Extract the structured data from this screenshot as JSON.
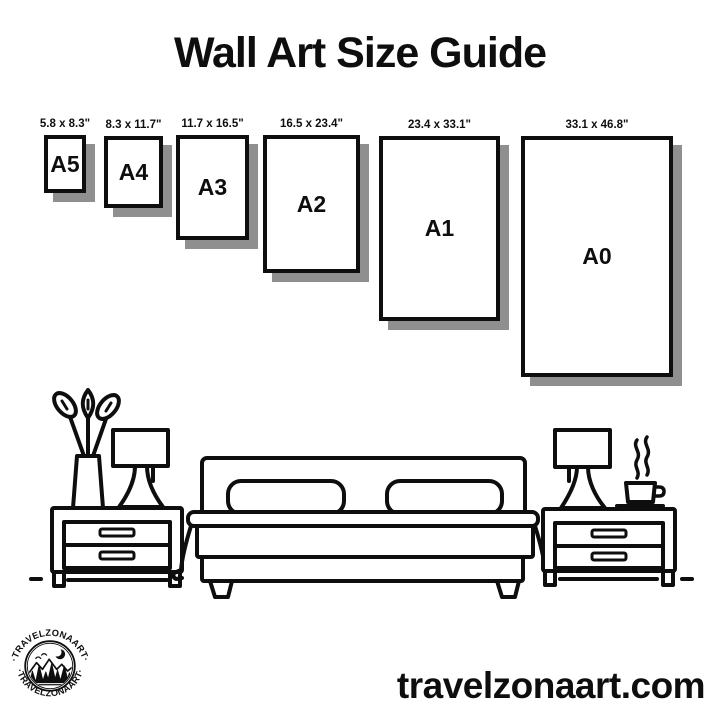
{
  "title": "Wall Art Size Guide",
  "sizes": [
    {
      "label": "A5",
      "dimensions": "5.8 x 8.3\""
    },
    {
      "label": "A4",
      "dimensions": "8.3 x 11.7\""
    },
    {
      "label": "A3",
      "dimensions": "11.7 x 16.5\""
    },
    {
      "label": "A2",
      "dimensions": "16.5 x 23.4\""
    },
    {
      "label": "A1",
      "dimensions": "23.4 x 33.1\""
    },
    {
      "label": "A0",
      "dimensions": "33.1 x 46.8\""
    }
  ],
  "logo": {
    "brand_text_top": "·TRAVELZONAART·",
    "brand_text_bottom": "·TRAVELZONAART·"
  },
  "footer": {
    "website": "travelzonaart.com"
  },
  "illustration": {
    "items": [
      "potted-plant",
      "table-lamp-left",
      "nightstand-left",
      "double-bed",
      "table-lamp-right",
      "coffee-cup",
      "nightstand-right",
      "floor-lines"
    ]
  },
  "colors": {
    "ink": "#0e0e0e",
    "shadow": "#8f8f8f",
    "bg": "#ffffff"
  }
}
